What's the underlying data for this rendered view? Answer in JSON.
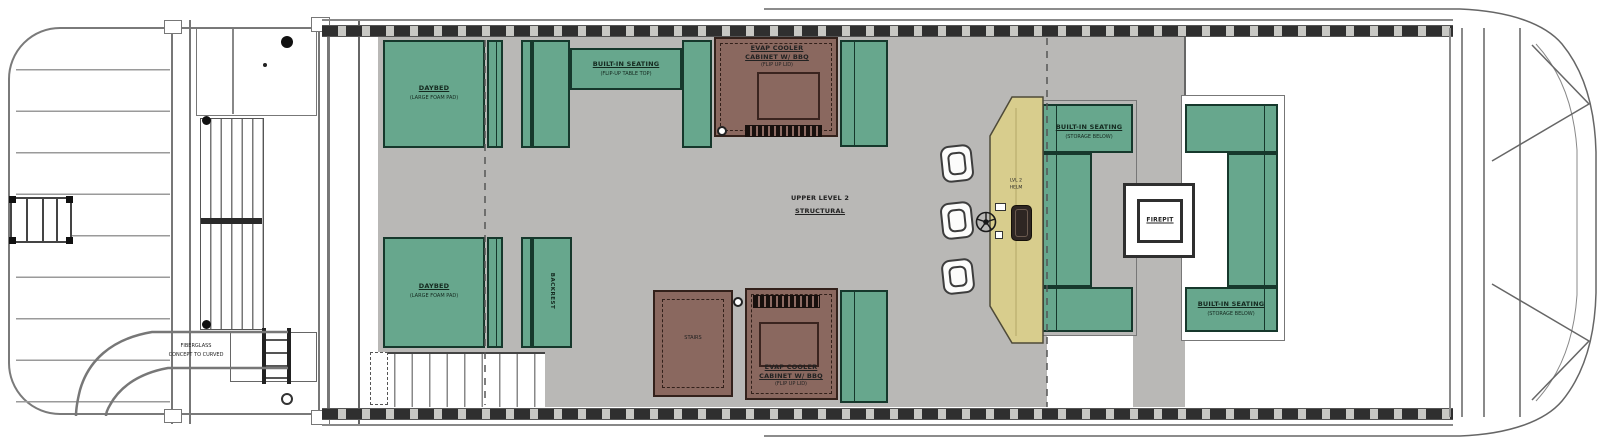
{
  "plan": {
    "title": "Pontoon boat upper deck floor plan",
    "center": {
      "line1": "UPPER LEVEL 2",
      "line2": "STRUCTURAL"
    },
    "bow": {
      "slide": {
        "line1": "FIBERGLASS",
        "line2": "CONCEPT TO CURVED"
      }
    },
    "port_lounge": {
      "daybed_fwd": {
        "label": "DAYBED",
        "sub": "(LARGE FOAM PAD)"
      },
      "daybed_aft": {
        "label": "DAYBED",
        "sub": "(LARGE FOAM PAD)"
      },
      "sofa": {
        "label": "BUILT-IN SEATING",
        "sub": "(FLIP-UP TABLE TOP)"
      },
      "backrest": {
        "label": "BACKREST"
      }
    },
    "galley": {
      "cooler_fwd": {
        "line1": "EVAP COOLER",
        "line2": "CABINET W/ BBQ",
        "line3": "(FLIP UP LID)"
      },
      "cooler_aft": {
        "line1": "EVAP COOLER",
        "line2": "CABINET W/ BBQ",
        "line3": "(FLIP UP LID)"
      },
      "stairwell": {
        "label": "STAIRS"
      },
      "helm": {
        "line1": "LVL 2",
        "line2": "HELM"
      }
    },
    "firepit_lounge": {
      "sofa_fwd": {
        "label": "BUILT-IN SEATING",
        "sub": "(STORAGE BELOW)"
      },
      "sofa_aft": {
        "label": "BUILT-IN SEATING",
        "sub": "(STORAGE BELOW)"
      },
      "firepit": {
        "label": "FIREPIT"
      }
    }
  },
  "colors": {
    "cushion": "#67a78d",
    "cabinet": "#8a685f",
    "bar_counter": "#d8cd8d",
    "deck": "#b9b8b6",
    "rail_hatch": "#2f2f2f"
  }
}
